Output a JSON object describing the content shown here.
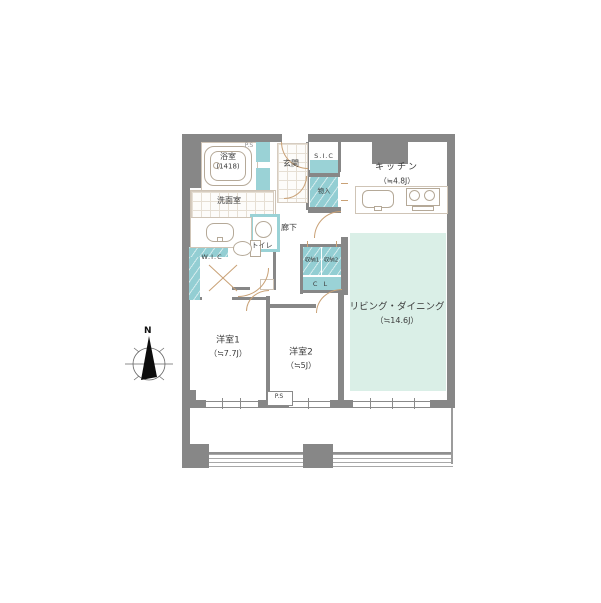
{
  "colors": {
    "wall": "#878787",
    "closet_teal": "#9ad2d6",
    "living_mint": "#daefe7",
    "door_swing": "#c9a176",
    "outline": "#cfc4b6"
  },
  "rooms": {
    "bath": {
      "name": "浴室",
      "size": "(1418)"
    },
    "powder_room": {
      "name": "洗面室"
    },
    "entrance": {
      "name": "玄関"
    },
    "shoe_closet": {
      "name": "S.I.C"
    },
    "storage": {
      "name": "物入"
    },
    "kitchen": {
      "name": "キッチン",
      "size": "（≒4.8J）"
    },
    "hallway": {
      "name": "廊下"
    },
    "wic": {
      "name": "W.I.C"
    },
    "toilet": {
      "name": "トイレ"
    },
    "closet1": {
      "name": "収納1"
    },
    "closet2": {
      "name": "収納2"
    },
    "closet_cl": {
      "name": "C L"
    },
    "living_dining": {
      "name": "リビング・ダイニング",
      "size": "（≒14.6J）"
    },
    "bedroom1": {
      "name": "洋室1",
      "size": "（≒7.7J）"
    },
    "bedroom2": {
      "name": "洋室2",
      "size": "（≒5J）"
    },
    "pipe_space": {
      "name": "P.S"
    },
    "pipe_space_top": {
      "name": "P.S"
    }
  },
  "compass": {
    "north_label": "N"
  }
}
